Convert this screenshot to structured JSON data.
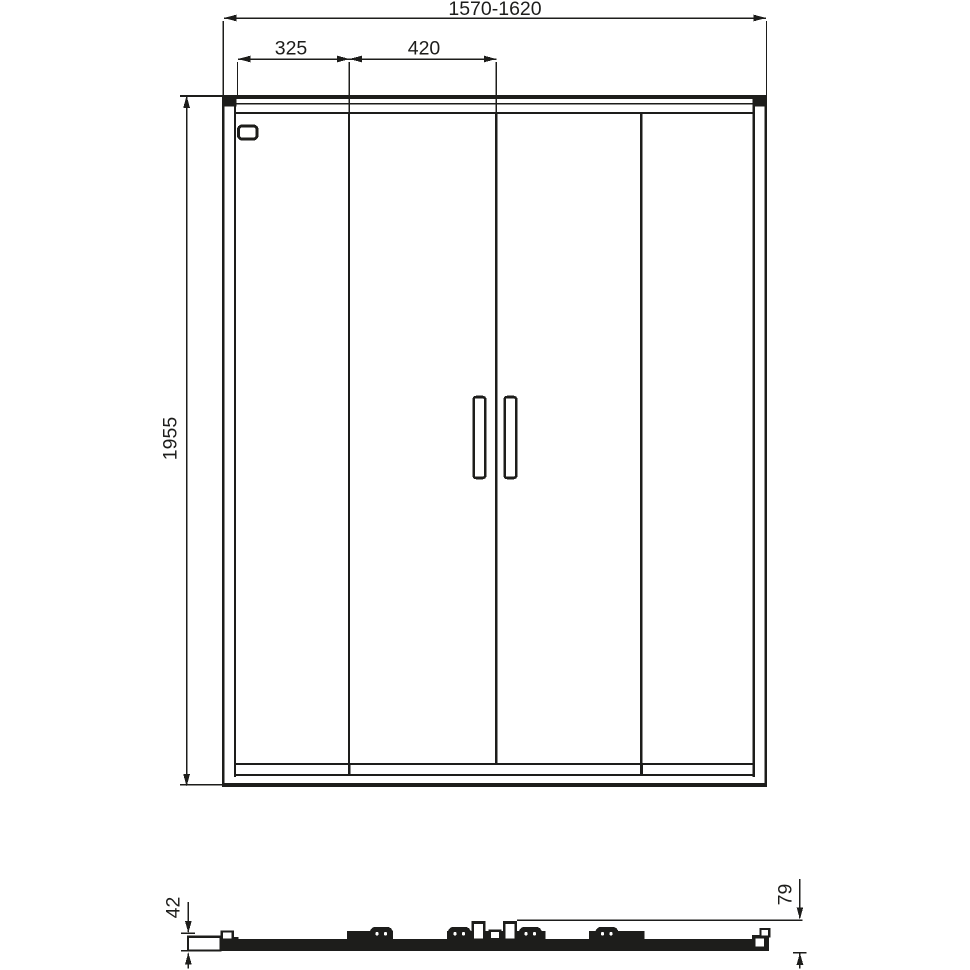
{
  "drawing": {
    "description": "Technical dimension drawing of a four-panel sliding shower door, front elevation with bottom section view"
  },
  "colors": {
    "line": "#1d1d1b",
    "background": "#ffffff"
  },
  "front_view": {
    "total_width": "1570-1620",
    "fixed_panel_width": "325",
    "door_panel_width": "420",
    "height": "1955"
  },
  "section_view": {
    "profile_height": "42",
    "total_depth": "79"
  }
}
